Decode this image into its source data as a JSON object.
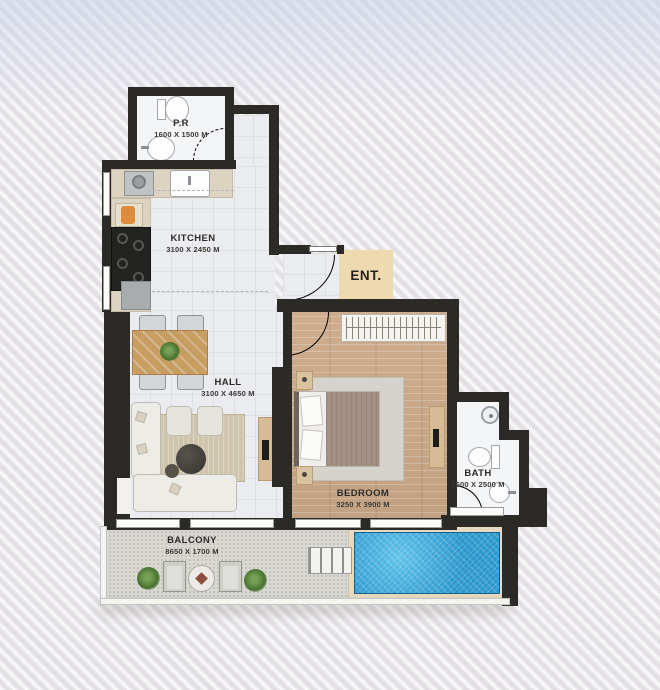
{
  "plan": {
    "entrance_label": "ENT.",
    "rooms": [
      {
        "key": "pr",
        "name": "P.R",
        "dims": "1600 X 1500 M"
      },
      {
        "key": "kitchen",
        "name": "KITCHEN",
        "dims": "3100 X 2450 M"
      },
      {
        "key": "hall",
        "name": "HALL",
        "dims": "3100 X 4650 M"
      },
      {
        "key": "bedroom",
        "name": "BEDROOM",
        "dims": "3250 X 3900 M"
      },
      {
        "key": "bath",
        "name": "BATH",
        "dims": "1500 X 2500 M"
      },
      {
        "key": "balcony",
        "name": "BALCONY",
        "dims": "8650 X 1700 M"
      }
    ],
    "fixtures": [
      "toilet",
      "washbasin",
      "washing-machine",
      "kitchen-sink",
      "stove",
      "fridge",
      "coffee-machine",
      "dining-table",
      "dining-chair",
      "plant",
      "sofa",
      "armchair",
      "coffee-table",
      "tv-console",
      "bed",
      "nightstand",
      "wardrobe",
      "shower",
      "pool",
      "pool-steps",
      "balcony-chair",
      "balcony-table",
      "window",
      "door-swing"
    ],
    "colors": {
      "wall": "#2b2a27",
      "tile_floor": "#eaecef",
      "wood_floor": "#c9a98b",
      "counter": "#ddd3c1",
      "entrance_pad": "#eedaae",
      "pool_water": "#2f9ed6",
      "pool_deck": "#e6dbc2",
      "rug": "#cfc5ad",
      "table_wood": "#c79d62",
      "background": "#e9e6ea"
    }
  }
}
